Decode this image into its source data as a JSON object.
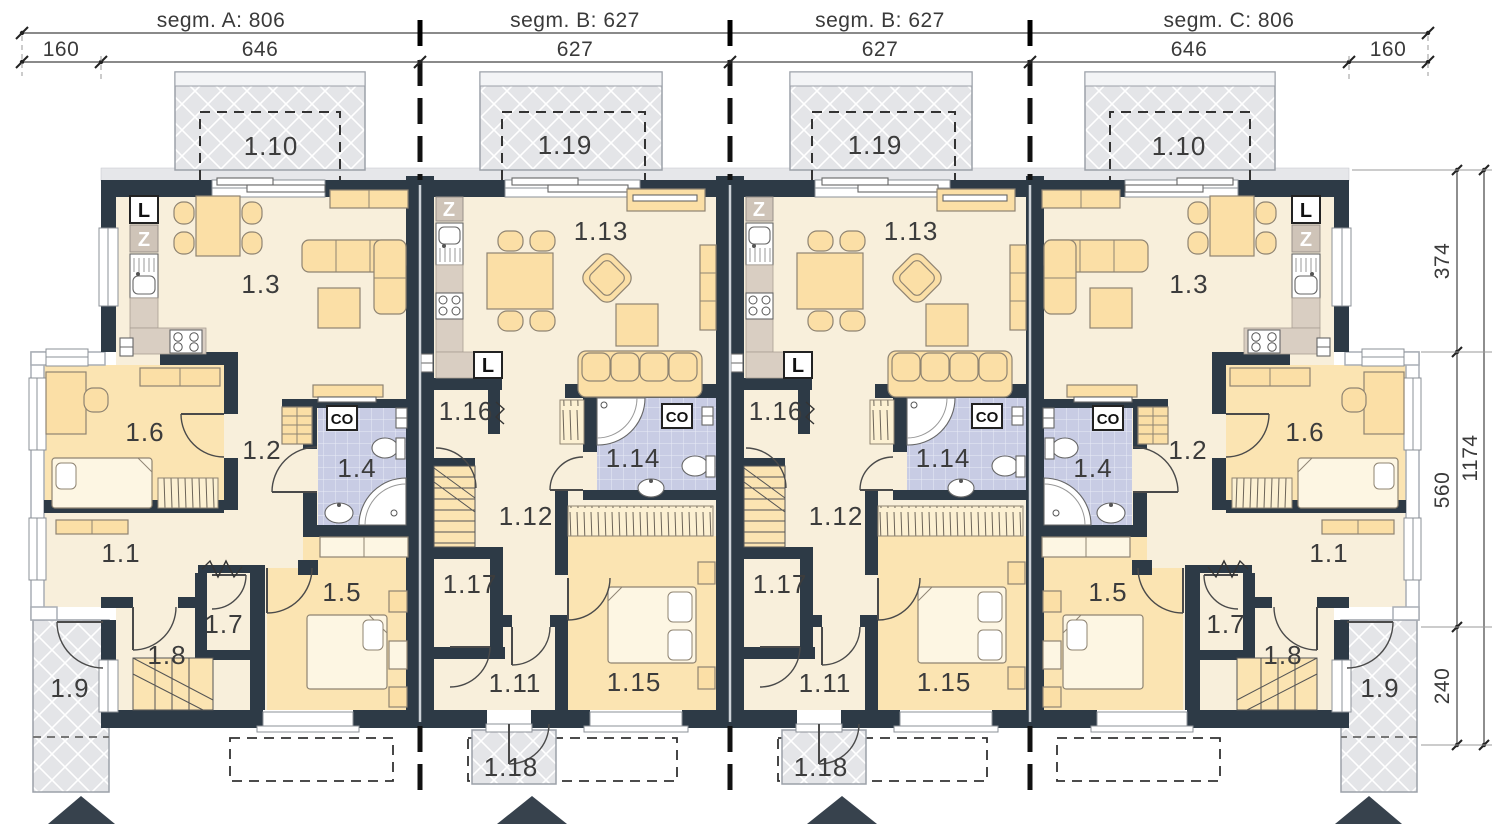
{
  "top_dimensions": {
    "segment_labels": [
      "segm. A: 806",
      "segm. B: 627",
      "segm. B: 627",
      "segm. C: 806"
    ],
    "width_labels": [
      "160",
      "646",
      "627",
      "627",
      "646",
      "160"
    ]
  },
  "right_dimensions": {
    "parts": [
      "374",
      "560",
      "240"
    ],
    "total": "1174"
  },
  "segments": [
    {
      "name": "segm. A: 806",
      "rooms": {
        "terrace": "1.10",
        "living": "1.3",
        "hall": "1.1",
        "corridor": "1.2",
        "bathroom": "1.4",
        "bedroom": "1.5",
        "room": "1.6",
        "closet": "1.7",
        "stairs": "1.8",
        "porch": "1.9"
      },
      "marks": {
        "fridge": "L",
        "pantry": "Z",
        "boiler": "CO"
      }
    },
    {
      "name": "segm. B: 627",
      "rooms": {
        "terrace": "1.19",
        "living": "1.13",
        "entry": "1.11",
        "hall": "1.12",
        "bathroom": "1.14",
        "bedroom": "1.15",
        "room": "1.16",
        "storage": "1.17",
        "porch": "1.18"
      },
      "marks": {
        "fridge": "L",
        "pantry": "Z",
        "boiler": "CO"
      }
    },
    {
      "name": "segm. B: 627",
      "rooms": {
        "terrace": "1.19",
        "living": "1.13",
        "entry": "1.11",
        "hall": "1.12",
        "bathroom": "1.14",
        "bedroom": "1.15",
        "room": "1.16",
        "storage": "1.17",
        "porch": "1.18"
      },
      "marks": {
        "fridge": "L",
        "pantry": "Z",
        "boiler": "CO"
      }
    },
    {
      "name": "segm. C: 806",
      "rooms": {
        "terrace": "1.10",
        "living": "1.3",
        "hall": "1.1",
        "corridor": "1.2",
        "bathroom": "1.4",
        "bedroom": "1.5",
        "room": "1.6",
        "closet": "1.7",
        "stairs": "1.8",
        "porch": "1.9"
      },
      "marks": {
        "fridge": "L",
        "pantry": "Z",
        "boiler": "CO"
      }
    }
  ]
}
